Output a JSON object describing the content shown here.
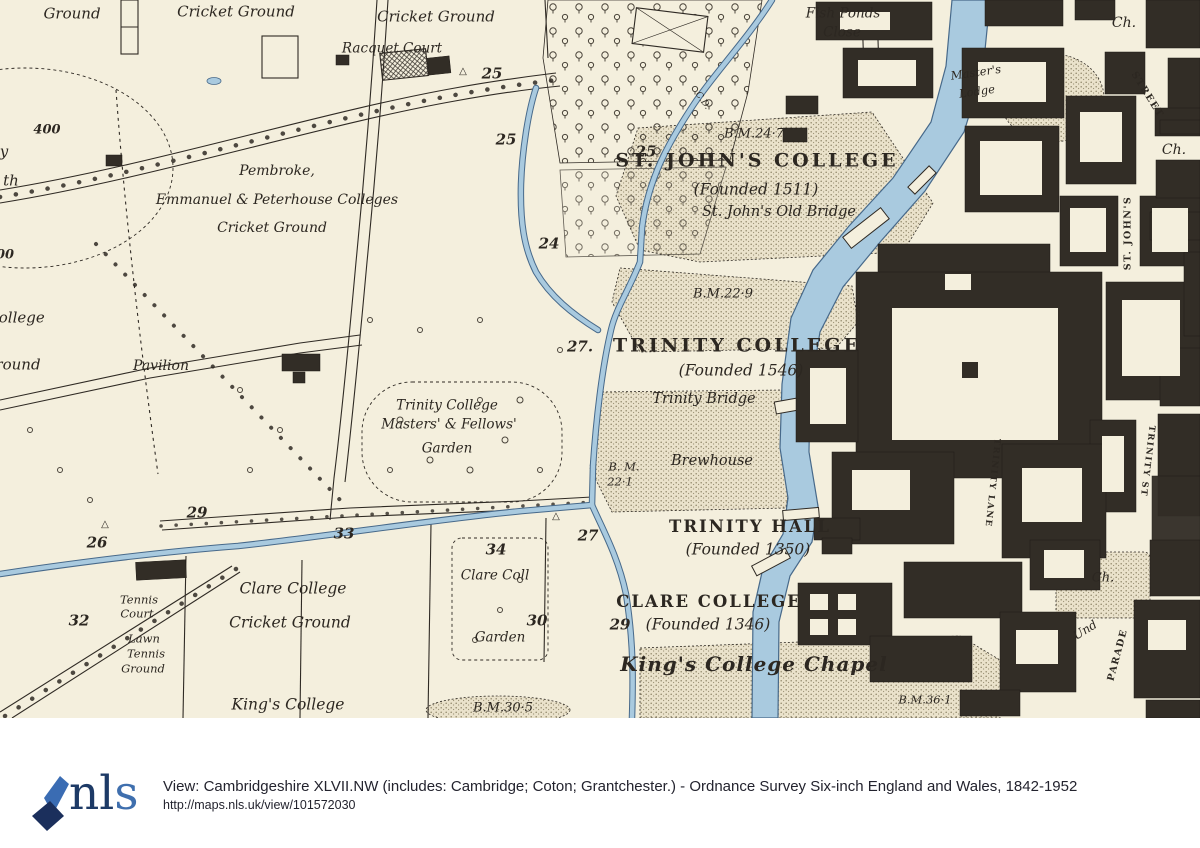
{
  "map": {
    "colors": {
      "paper": "#f4efdd",
      "ink": "#2c2721",
      "river_fill": "#a9cadf",
      "river_edge": "#47698a",
      "building": "#322d26",
      "stipple": "#8f8669"
    },
    "labels": [
      {
        "text": "Ground",
        "x": 72,
        "y": 14,
        "cls": "it",
        "fs": 15
      },
      {
        "text": "Cricket Ground",
        "x": 236,
        "y": 12,
        "cls": "it",
        "fs": 15
      },
      {
        "text": "Cricket Ground",
        "x": 436,
        "y": 17,
        "cls": "it",
        "fs": 15
      },
      {
        "text": "Racquet Court",
        "x": 392,
        "y": 49,
        "cls": "it"
      },
      {
        "text": "25",
        "x": 492,
        "y": 74,
        "cls": "num"
      },
      {
        "text": "△",
        "x": 463,
        "y": 72,
        "cls": "tri"
      },
      {
        "text": "Fish Ponds",
        "x": 843,
        "y": 14,
        "cls": "it"
      },
      {
        "text": "Close",
        "x": 842,
        "y": 33,
        "cls": "it"
      },
      {
        "text": "Ch.",
        "x": 1124,
        "y": 23,
        "cls": "it",
        "fs": 14
      },
      {
        "text": "STREET",
        "x": 1147,
        "y": 95,
        "cls": "street",
        "rot": 58
      },
      {
        "text": "Master's",
        "x": 976,
        "y": 73,
        "cls": "itsm",
        "rot": -8
      },
      {
        "text": "Lodge",
        "x": 977,
        "y": 92,
        "cls": "itsm",
        "rot": -8
      },
      {
        "text": "B.M.24·7",
        "x": 754,
        "y": 134,
        "cls": "bm",
        "fs": 13
      },
      {
        "text": "25",
        "x": 506,
        "y": 140,
        "cls": "num"
      },
      {
        "text": "25",
        "x": 646,
        "y": 152,
        "cls": "num"
      },
      {
        "text": "ST. JOHN'S COLLEGE",
        "x": 757,
        "y": 161,
        "cls": "caps"
      },
      {
        "text": "(Founded 1511)",
        "x": 756,
        "y": 190,
        "cls": "itlg"
      },
      {
        "text": "St. John's Old Bridge",
        "x": 779,
        "y": 212,
        "cls": "itlg",
        "fs": 14.5
      },
      {
        "text": "Ch.",
        "x": 1174,
        "y": 150,
        "cls": "it",
        "fs": 14
      },
      {
        "text": "ST. JOHN'S",
        "x": 1128,
        "y": 233,
        "cls": "street",
        "rot": -90
      },
      {
        "text": "400",
        "x": 47,
        "y": 130,
        "cls": "num",
        "fs": 13
      },
      {
        "text": "y",
        "x": 4,
        "y": 152,
        "cls": "it",
        "fs": 15
      },
      {
        "text": "th",
        "x": 11,
        "y": 181,
        "cls": "it",
        "fs": 15
      },
      {
        "text": "Pembroke,",
        "x": 277,
        "y": 171,
        "cls": "it",
        "fs": 14
      },
      {
        "text": "Emmanuel & Peterhouse Colleges",
        "x": 277,
        "y": 200,
        "cls": "it",
        "fs": 14
      },
      {
        "text": "Cricket Ground",
        "x": 272,
        "y": 228,
        "cls": "it",
        "fs": 14
      },
      {
        "text": "24",
        "x": 549,
        "y": 244,
        "cls": "num"
      },
      {
        "text": "00",
        "x": 5,
        "y": 255,
        "cls": "num",
        "fs": 13
      },
      {
        "text": "C.D.",
        "x": 702,
        "y": 101,
        "cls": "bm",
        "rot": 55,
        "fs": 9
      },
      {
        "text": "B.M.22·9",
        "x": 723,
        "y": 294,
        "cls": "bm",
        "fs": 13
      },
      {
        "text": "College",
        "x": 16,
        "y": 318,
        "cls": "it",
        "fs": 15
      },
      {
        "text": "Ground",
        "x": 12,
        "y": 365,
        "cls": "it",
        "fs": 15
      },
      {
        "text": "Pavilion",
        "x": 161,
        "y": 366,
        "cls": "it",
        "fs": 14
      },
      {
        "text": "27.",
        "x": 580,
        "y": 347,
        "cls": "num"
      },
      {
        "text": "TRINITY COLLEGE",
        "x": 737,
        "y": 346,
        "cls": "caps"
      },
      {
        "text": "(Founded 1546)",
        "x": 741,
        "y": 371,
        "cls": "itlg"
      },
      {
        "text": "Trinity Bridge",
        "x": 704,
        "y": 399,
        "cls": "itlg",
        "fs": 14.5
      },
      {
        "text": "Trinity College",
        "x": 447,
        "y": 406,
        "cls": "it"
      },
      {
        "text": "Masters' & Fellows'",
        "x": 449,
        "y": 425,
        "cls": "it"
      },
      {
        "text": "Garden",
        "x": 447,
        "y": 449,
        "cls": "it"
      },
      {
        "text": "Brewhouse",
        "x": 712,
        "y": 461,
        "cls": "itlg",
        "fs": 14.5
      },
      {
        "text": "B. M.",
        "x": 624,
        "y": 467,
        "cls": "bm"
      },
      {
        "text": "22·1",
        "x": 620,
        "y": 482,
        "cls": "bm"
      },
      {
        "text": "TRINITY LANE",
        "x": 992,
        "y": 483,
        "cls": "street",
        "rot": 96,
        "fs": 8.5
      },
      {
        "text": "TRINITY ST",
        "x": 1147,
        "y": 461,
        "cls": "street",
        "rot": 97,
        "fs": 8.5
      },
      {
        "text": "29",
        "x": 197,
        "y": 513,
        "cls": "num"
      },
      {
        "text": "△",
        "x": 105,
        "y": 525,
        "cls": "tri"
      },
      {
        "text": "△",
        "x": 556,
        "y": 517,
        "cls": "tri"
      },
      {
        "text": "27",
        "x": 588,
        "y": 536,
        "cls": "num"
      },
      {
        "text": "TRINITY HALL",
        "x": 750,
        "y": 527,
        "cls": "caps2"
      },
      {
        "text": "(Founded 1350)",
        "x": 748,
        "y": 550,
        "cls": "itlg"
      },
      {
        "text": "26",
        "x": 97,
        "y": 543,
        "cls": "num"
      },
      {
        "text": "33",
        "x": 344,
        "y": 534,
        "cls": "num"
      },
      {
        "text": "34",
        "x": 496,
        "y": 550,
        "cls": "num"
      },
      {
        "text": "Clare Coll",
        "x": 495,
        "y": 576,
        "cls": "it"
      },
      {
        "text": "Ch.",
        "x": 1103,
        "y": 578,
        "cls": "it",
        "fs": 13
      },
      {
        "text": "Tennis",
        "x": 139,
        "y": 600,
        "cls": "itsm"
      },
      {
        "text": "Court",
        "x": 137,
        "y": 614,
        "cls": "itsm"
      },
      {
        "text": "Clare College",
        "x": 293,
        "y": 589,
        "cls": "itlg"
      },
      {
        "text": "CLARE COLLEGE",
        "x": 709,
        "y": 602,
        "cls": "caps2"
      },
      {
        "text": "32",
        "x": 79,
        "y": 621,
        "cls": "num"
      },
      {
        "text": "30",
        "x": 537,
        "y": 621,
        "cls": "num"
      },
      {
        "text": "29",
        "x": 620,
        "y": 625,
        "cls": "num"
      },
      {
        "text": "(Founded 1346)",
        "x": 708,
        "y": 625,
        "cls": "itlg"
      },
      {
        "text": "Cricket Ground",
        "x": 290,
        "y": 623,
        "cls": "itlg"
      },
      {
        "text": "Garden",
        "x": 500,
        "y": 638,
        "cls": "it"
      },
      {
        "text": "Lawn",
        "x": 144,
        "y": 639,
        "cls": "itsm"
      },
      {
        "text": "Tennis",
        "x": 146,
        "y": 654,
        "cls": "itsm"
      },
      {
        "text": "Ground",
        "x": 143,
        "y": 669,
        "cls": "itsm"
      },
      {
        "text": "Und",
        "x": 1085,
        "y": 630,
        "cls": "it",
        "rot": -32,
        "fs": 12
      },
      {
        "text": "PARADE",
        "x": 1118,
        "y": 655,
        "cls": "street",
        "rot": -75
      },
      {
        "text": "King's College Chapel",
        "x": 754,
        "y": 664,
        "cls": "frak"
      },
      {
        "text": "King's College",
        "x": 288,
        "y": 705,
        "cls": "itlg"
      },
      {
        "text": "B.M.30·5",
        "x": 503,
        "y": 708,
        "cls": "bm",
        "fs": 13
      },
      {
        "text": "B.M.36·1",
        "x": 925,
        "y": 700,
        "cls": "bm"
      }
    ]
  },
  "footer": {
    "logo_part1": "nl",
    "logo_part2": "s",
    "line1": "View: Cambridgeshire XLVII.NW (includes: Cambridge; Coton; Grantchester.) - Ordnance Survey Six-inch England and Wales, 1842-1952",
    "line2": "http://maps.nls.uk/view/101572030"
  }
}
